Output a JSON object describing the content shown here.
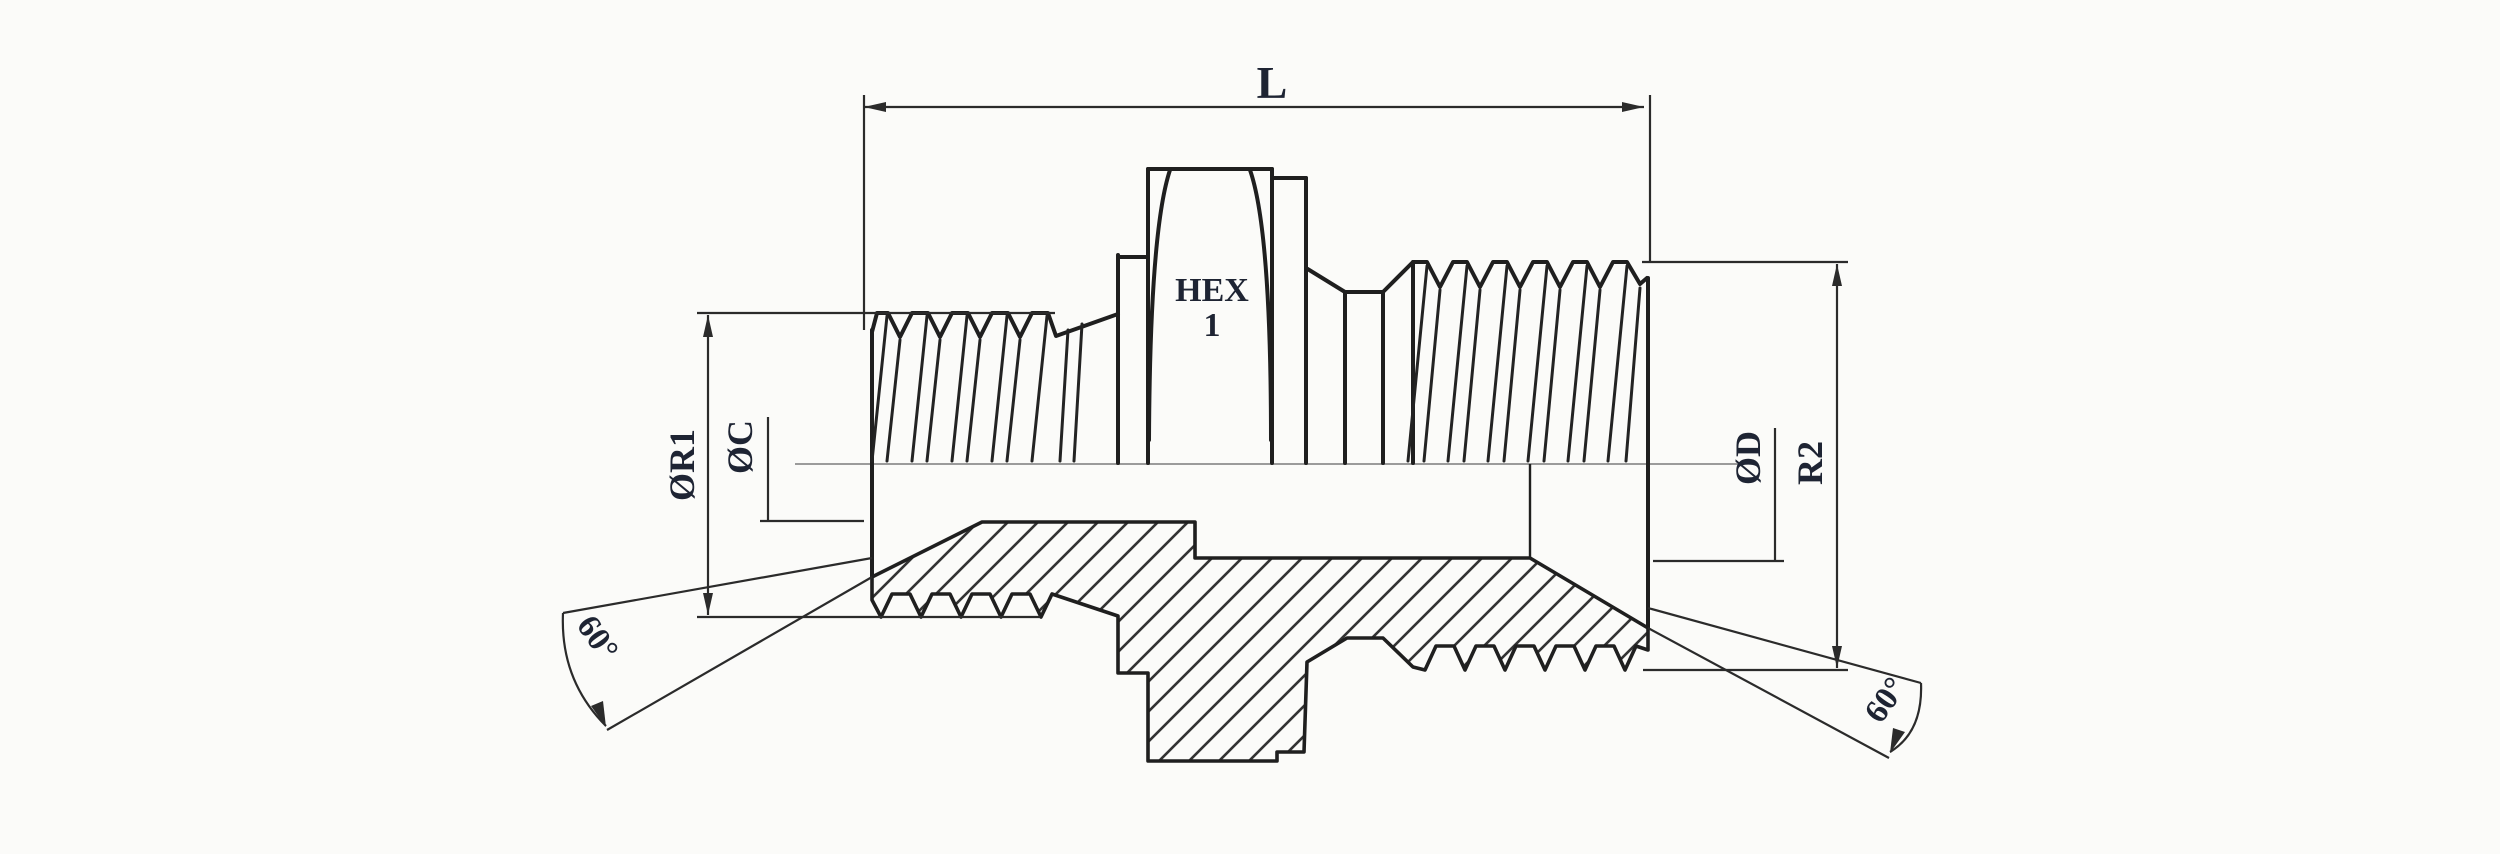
{
  "drawing": {
    "labels": {
      "length": "L",
      "hex_line1": "HEX",
      "hex_line2": "1",
      "left_thread_diameter": "ØR1",
      "left_bore_diameter": "ØC",
      "right_bore_diameter": "ØD",
      "right_thread_diameter": "R2",
      "left_angle": "60°",
      "right_angle": "60°"
    },
    "colors": {
      "background": "#fbfbf9",
      "line": "#1f1f1f",
      "dimension_line": "#2b2b2b",
      "centerline": "#9b9b9b",
      "text": "#1e2433"
    }
  }
}
